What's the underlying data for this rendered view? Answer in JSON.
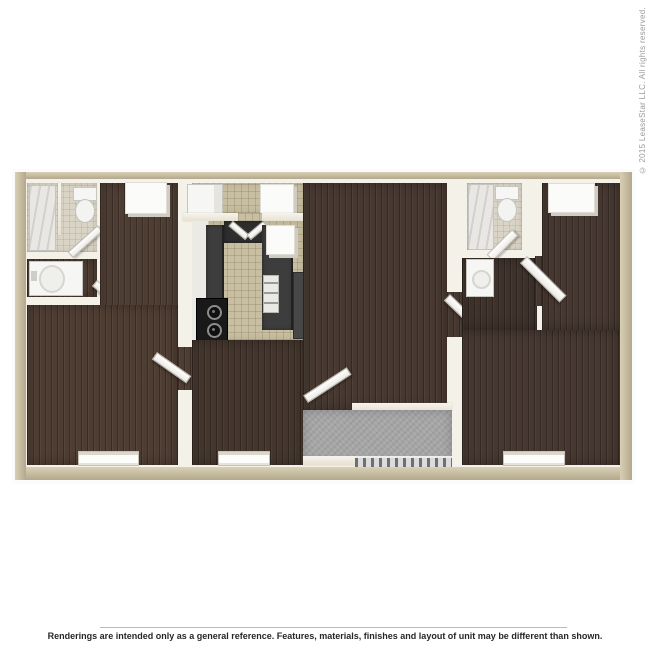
{
  "page": {
    "background_color": "#ffffff"
  },
  "watermark": {
    "copyright": "© 2015 LeaseStar LLC. All rights reserved."
  },
  "footer": {
    "disclaimer": "Renderings are intended only as a general reference. Features, materials, finishes and layout of unit may be different than shown."
  },
  "palette": {
    "outer_wall_tan": "#cdc3a8",
    "inner_wall_white": "#f4f1e9",
    "wood_floor_dark": "#46382f",
    "kitchen_tile_beige": "#c8bea1",
    "bath_tile_beige": "#dad4c6",
    "patio_concrete_gray": "#a5a5a5",
    "counter_dark": "#3d3d3d",
    "appliance_black": "#1a1a1a",
    "fixture_white": "#f6f6f4"
  }
}
